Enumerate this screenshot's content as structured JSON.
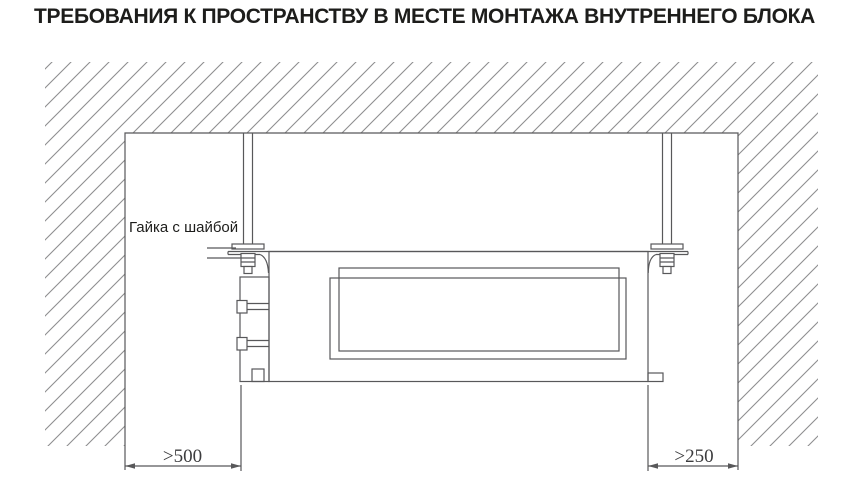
{
  "title": "ТРЕБОВАНИЯ К ПРОСТРАНСТВУ В МЕСТЕ МОНТАЖА ВНУТРЕННЕГО БЛОКА",
  "diagram": {
    "callout": {
      "label": "Гайка с шайбой"
    },
    "dimensions": {
      "left_clearance": ">500",
      "right_clearance": ">250"
    }
  },
  "colors": {
    "title_text": "#1d1d1b",
    "hatch": "#8e8e90",
    "line": "#58585a",
    "dim_text": "#3c3c3e",
    "background": "#ffffff",
    "fill_white": "#ffffff"
  }
}
